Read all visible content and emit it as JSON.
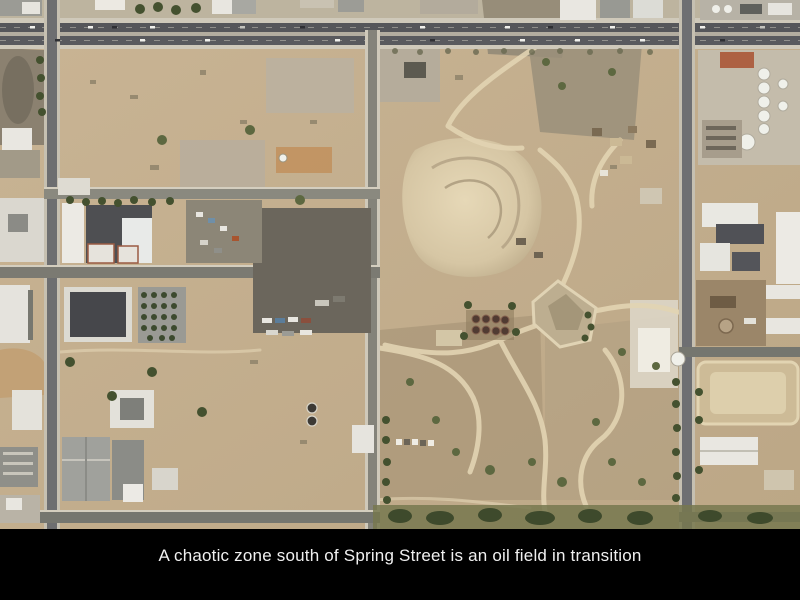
{
  "slide": {
    "background_color": "#000000",
    "caption": {
      "text": "A chaotic zone south of Spring Street is an oil field in transition",
      "color": "#f0f0f0"
    },
    "photo": {
      "kind": "aerial-orthophoto",
      "palette": {
        "dirt_tan": "#c5b08f",
        "light_dirt_track": "#e2d4b3",
        "asphalt_dark": "#55565a",
        "asphalt_light": "#84837a",
        "concrete_sidewalk": "#cfc9ba",
        "scrub_gray": "#8b8170",
        "junkyard_gray": "#6b665c",
        "white_roof": "#e9e7e1",
        "dark_roof": "#4e4f52",
        "red_roof": "#ad6143",
        "tank_maroon": "#503b32",
        "vegetation_dark": "#44512f",
        "vegetation_olive": "#77784f"
      }
    }
  }
}
